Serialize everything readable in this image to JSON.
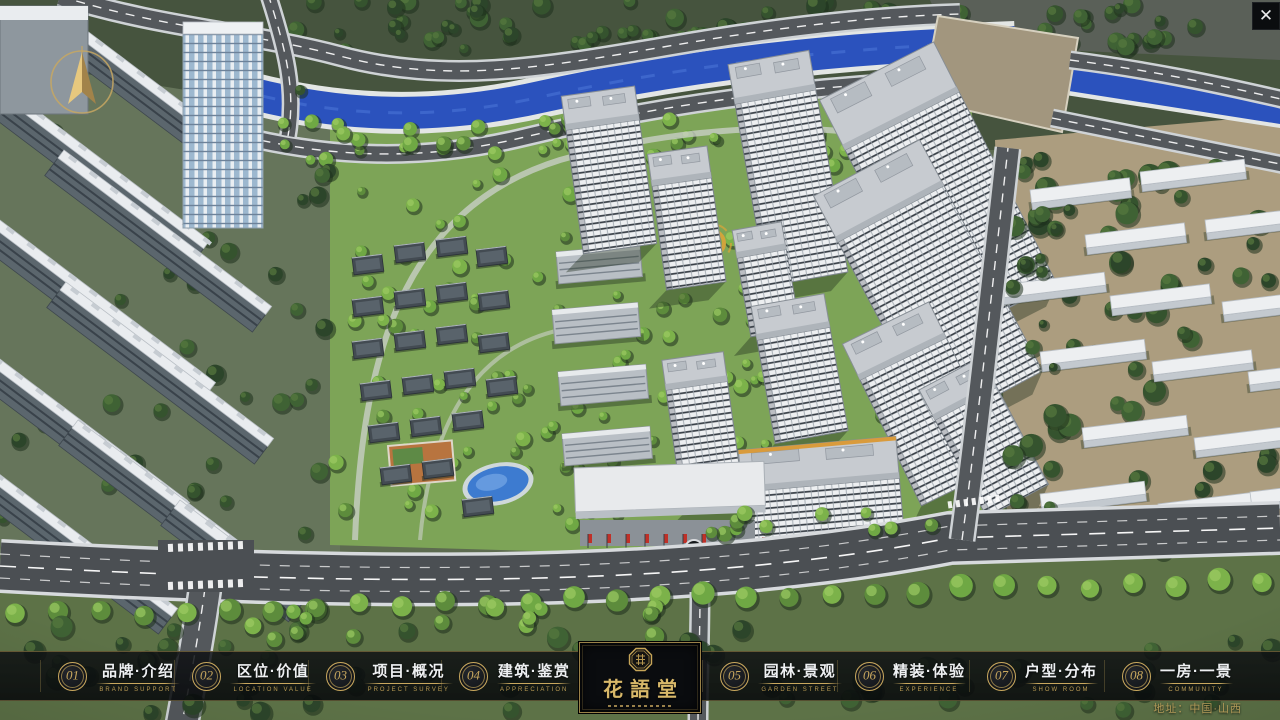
{
  "window": {
    "close_symbol": "✕"
  },
  "colors": {
    "gold": "#c9a85e",
    "bar_background": "rgba(12,14,17,0.84)",
    "water": "#2b52bd",
    "road": "#54585c",
    "lawn": "#7da457",
    "right_district_ground": "#ac9d7f",
    "white_building": "#edeff1",
    "dark_roof": "#434b52",
    "flag_red": "#c03028",
    "pool_blue": "#3d7bd0"
  },
  "logo": {
    "title": "花語堂"
  },
  "address": "地址：中国·山西",
  "menu": {
    "items": [
      {
        "key": "brand-intro",
        "number": "01",
        "title": "品牌·介绍",
        "subtitle": "BRAND SUPPORT"
      },
      {
        "key": "location-value",
        "number": "02",
        "title": "区位·价值",
        "subtitle": "LOCATION VALUE"
      },
      {
        "key": "project-overview",
        "number": "03",
        "title": "项目·概况",
        "subtitle": "PROJECT SURVEY"
      },
      {
        "key": "architecture",
        "number": "04",
        "title": "建筑·鉴赏",
        "subtitle": "APPRECIATION"
      },
      {
        "key": "garden-landscape",
        "number": "05",
        "title": "园林·景观",
        "subtitle": "GARDEN STREET"
      },
      {
        "key": "decor-experience",
        "number": "06",
        "title": "精装·体验",
        "subtitle": "EXPERIENCE"
      },
      {
        "key": "unit-distribution",
        "number": "07",
        "title": "户型·分布",
        "subtitle": "SHOW ROOM"
      },
      {
        "key": "one-room-one-view",
        "number": "08",
        "title": "一房·一景",
        "subtitle": "COMMUNITY"
      }
    ],
    "left_positions": [
      58,
      192,
      326,
      459
    ],
    "right_positions": [
      720,
      855,
      987,
      1122
    ]
  },
  "scene": {
    "towers": [
      [
        566,
        130,
        74,
        34,
        125,
        -8
      ],
      [
        652,
        186,
        60,
        32,
        105,
        -8
      ],
      [
        735,
        104,
        82,
        40,
        185,
        -10
      ],
      [
        737,
        258,
        50,
        28,
        80,
        -10
      ],
      [
        845,
        150,
        128,
        56,
        215,
        -27
      ],
      [
        838,
        242,
        120,
        52,
        210,
        -28
      ],
      [
        860,
        380,
        96,
        40,
        140,
        -26
      ],
      [
        935,
        420,
        70,
        34,
        110,
        -28
      ],
      [
        757,
        340,
        74,
        34,
        105,
        -10
      ],
      [
        666,
        390,
        62,
        30,
        125,
        -8
      ],
      [
        742,
        492,
        158,
        42,
        58,
        -5
      ]
    ],
    "midrises": [
      [
        556,
        252,
        84,
        32,
        -5
      ],
      [
        552,
        310,
        86,
        34,
        -5
      ],
      [
        558,
        372,
        88,
        34,
        -5
      ],
      [
        562,
        434,
        88,
        32,
        -5
      ],
      [
        598,
        478,
        80,
        30,
        -4
      ]
    ],
    "houses": [
      [
        352,
        258
      ],
      [
        394,
        246
      ],
      [
        436,
        240
      ],
      [
        476,
        250
      ],
      [
        352,
        300
      ],
      [
        394,
        292
      ],
      [
        436,
        286
      ],
      [
        478,
        294
      ],
      [
        352,
        342
      ],
      [
        394,
        334
      ],
      [
        436,
        328
      ],
      [
        478,
        336
      ],
      [
        360,
        384
      ],
      [
        402,
        378
      ],
      [
        444,
        372
      ],
      [
        486,
        380
      ],
      [
        368,
        426
      ],
      [
        410,
        420
      ],
      [
        452,
        414
      ],
      [
        380,
        468
      ],
      [
        422,
        462
      ],
      [
        462,
        500
      ]
    ],
    "left_slabs": [
      [
        -30,
        60,
        300
      ],
      [
        70,
        18,
        230
      ],
      [
        -40,
        190,
        320
      ],
      [
        64,
        150,
        260
      ],
      [
        -52,
        320,
        300
      ],
      [
        66,
        282,
        260
      ],
      [
        -30,
        452,
        260
      ],
      [
        78,
        420,
        240
      ],
      [
        180,
        500,
        160
      ]
    ],
    "right_slabs": [
      [
        1030,
        190,
        100
      ],
      [
        1140,
        172,
        105
      ],
      [
        1085,
        235,
        100
      ],
      [
        1205,
        220,
        95
      ],
      [
        1000,
        285,
        105
      ],
      [
        1110,
        296,
        100
      ],
      [
        1222,
        302,
        90
      ],
      [
        1040,
        352,
        105
      ],
      [
        1152,
        362,
        100
      ],
      [
        1248,
        372,
        80
      ],
      [
        1082,
        428,
        105
      ],
      [
        1194,
        438,
        95
      ],
      [
        1040,
        494,
        105
      ],
      [
        1158,
        504,
        100
      ],
      [
        1250,
        492,
        70
      ]
    ]
  }
}
